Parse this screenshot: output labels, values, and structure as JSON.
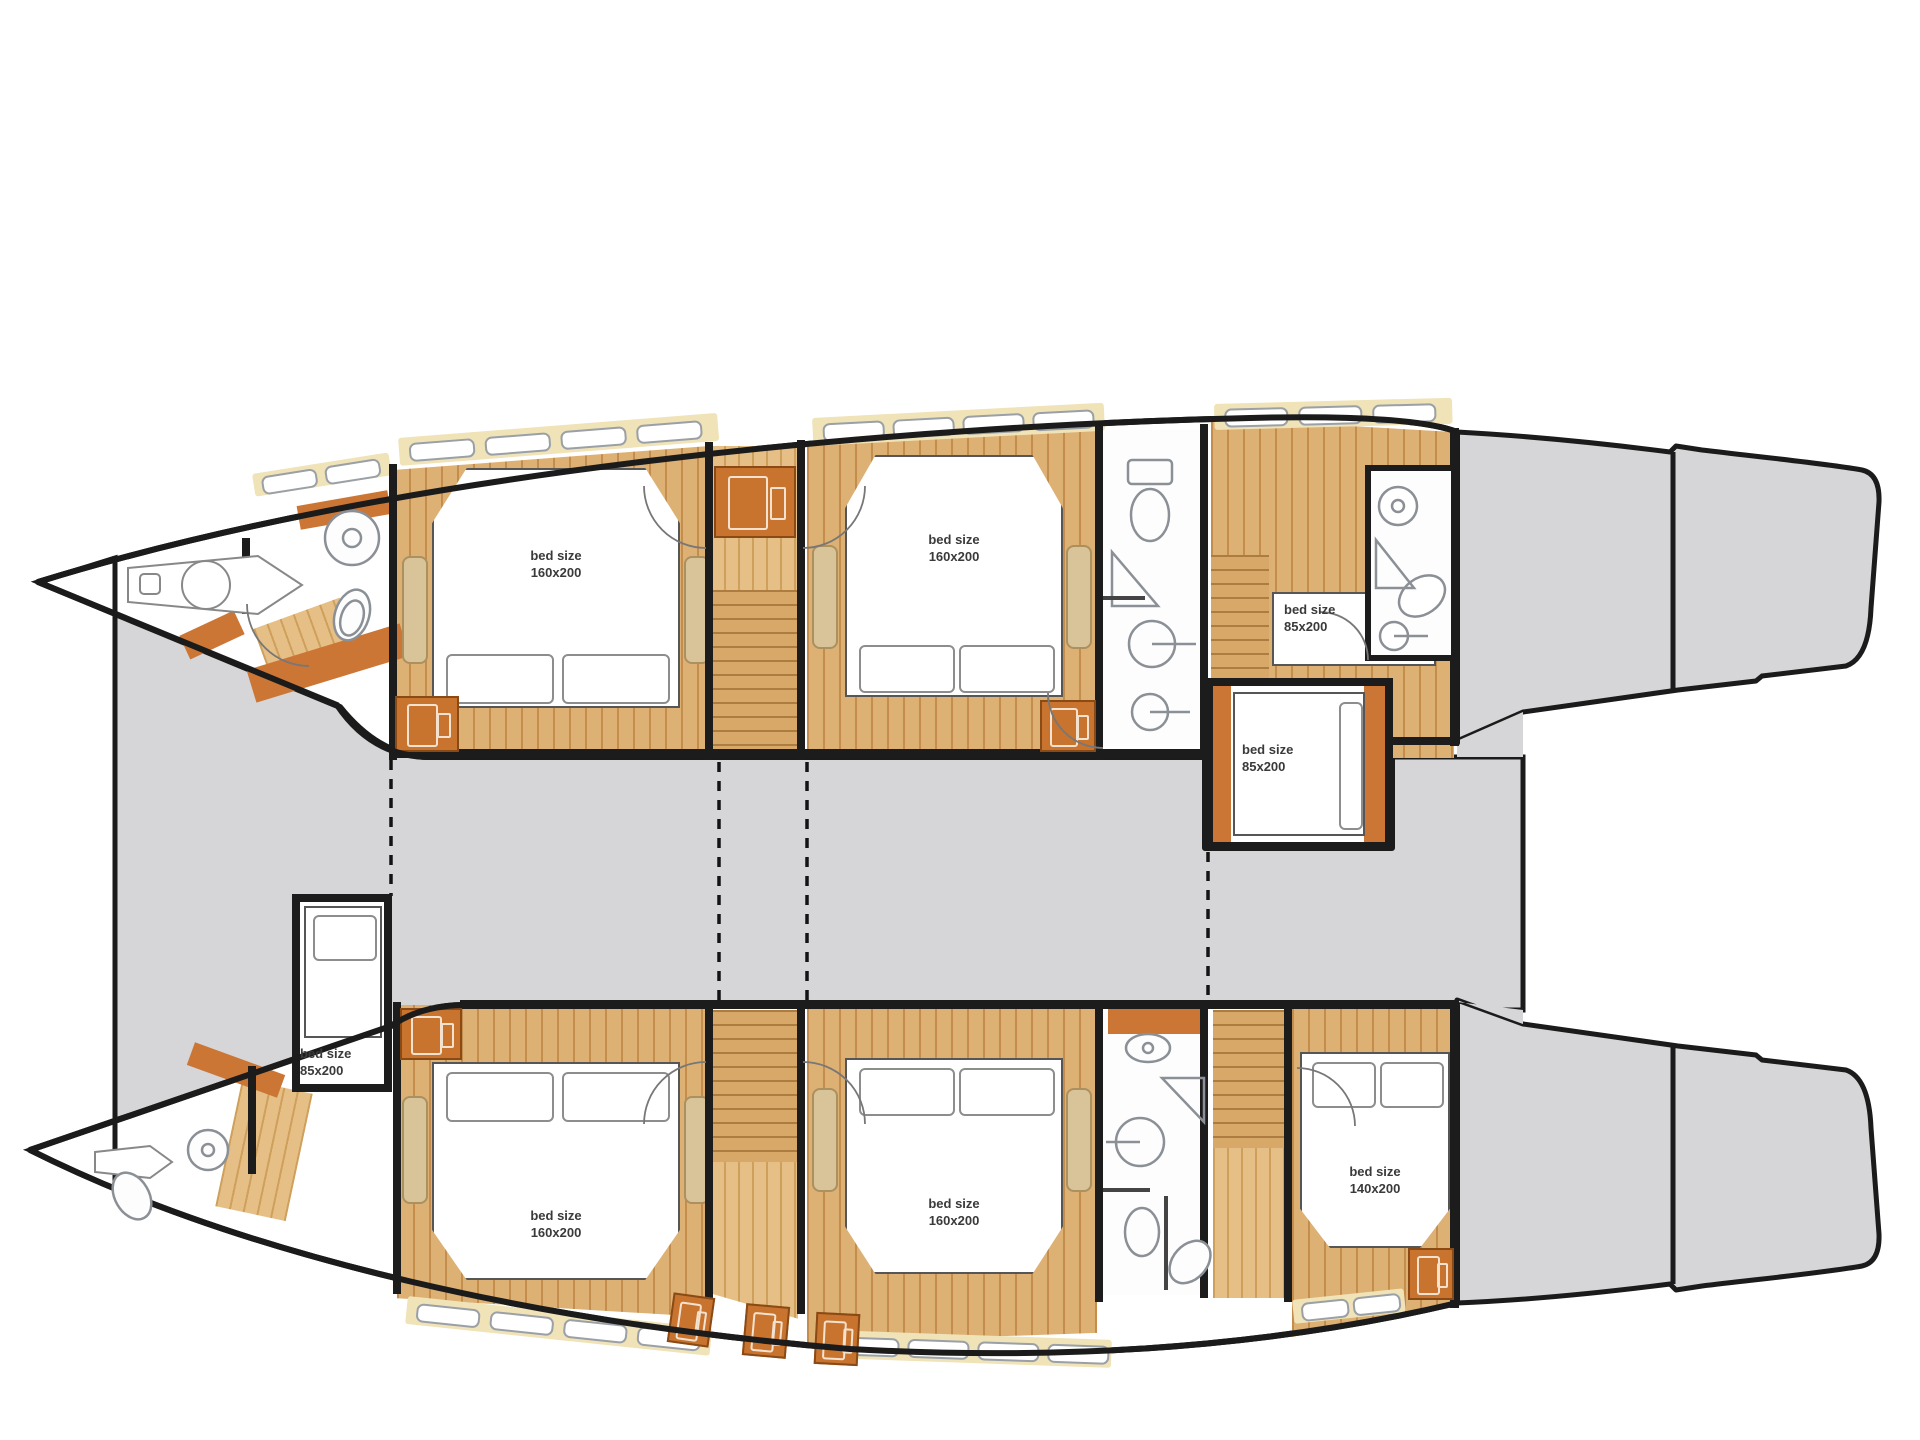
{
  "title": "catamaran lower deck floor plan",
  "colors": {
    "deck_gray": "#d6d6d8",
    "hull_outline": "#1b1b1b",
    "wood": "#ddb074",
    "wood_dark": "#c48d4c",
    "cream_band": "#f0e3b8",
    "orange_furniture": "#cc7636",
    "bench_tan": "#d9c398",
    "fixture_outline": "#8b9096",
    "label_text": "#3a3a3a"
  },
  "labels": {
    "port_fwd_cabin": "bed size\n160x200",
    "port_mid_cabin": "bed size\n160x200",
    "port_aft_single_upper": "bed size\n85x200",
    "port_aft_single_lower": "bed size\n85x200",
    "stbd_fwd_single": "bed size\n85x200",
    "stbd_fwd_cabin": "bed size\n160x200",
    "stbd_mid_cabin": "bed size\n160x200",
    "stbd_aft_cabin": "bed size\n140x200"
  },
  "rooms": {
    "port_hull": [
      "bow-locker",
      "forward-bathroom",
      "double-cabin-160x200",
      "staircase",
      "double-cabin-160x200",
      "bathroom",
      "single-beds-85x200",
      "aft-bathroom"
    ],
    "starboard_hull": [
      "bow-bathroom",
      "single-cabin-85x200",
      "double-cabin-160x200",
      "staircase",
      "double-cabin-160x200",
      "bathroom",
      "staircase",
      "double-cabin-140x200"
    ],
    "center": [
      "bridge-deck",
      "port-aft-deck",
      "starboard-aft-deck",
      "swim-platform"
    ]
  },
  "icons": [
    "toilet-icon",
    "sink-icon",
    "shower-icon",
    "wardrobe-icon",
    "bed-icon",
    "pillow-icon",
    "window-icon",
    "stairs-icon",
    "door-swing-icon",
    "hatch-icon"
  ]
}
